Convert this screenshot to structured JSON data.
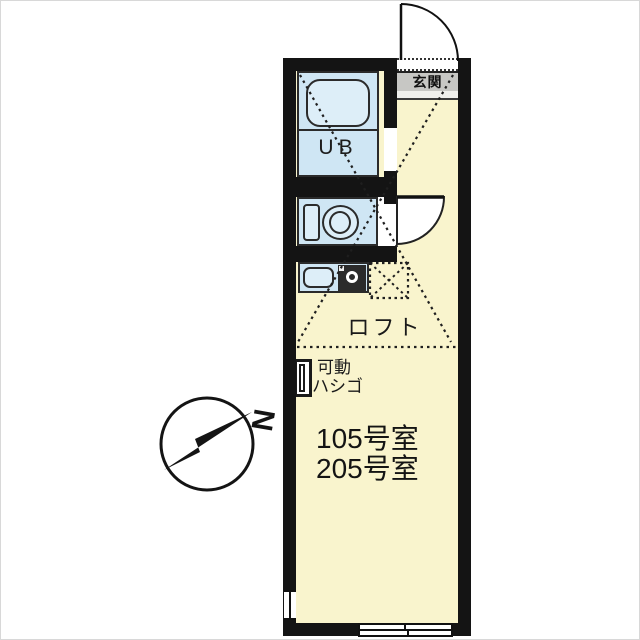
{
  "plan": {
    "type": "apartment-floor-plan",
    "labels": {
      "entrance": "玄関",
      "unit_bath": "UB",
      "loft": "ロフト",
      "movable_ladder": [
        "可動",
        "ハシゴ"
      ],
      "room_numbers": [
        "105号室",
        "205号室"
      ]
    },
    "compass": {
      "north": "N"
    },
    "colors": {
      "wall": "#141414",
      "room_fill": "#f9f4cd",
      "wet_area_fill": "#cfe6f4",
      "fixture_fill": "#ddeef8",
      "entrance_fill": "#c7c7c4",
      "line": "#2b2b2b",
      "background": "#ffffff"
    }
  }
}
